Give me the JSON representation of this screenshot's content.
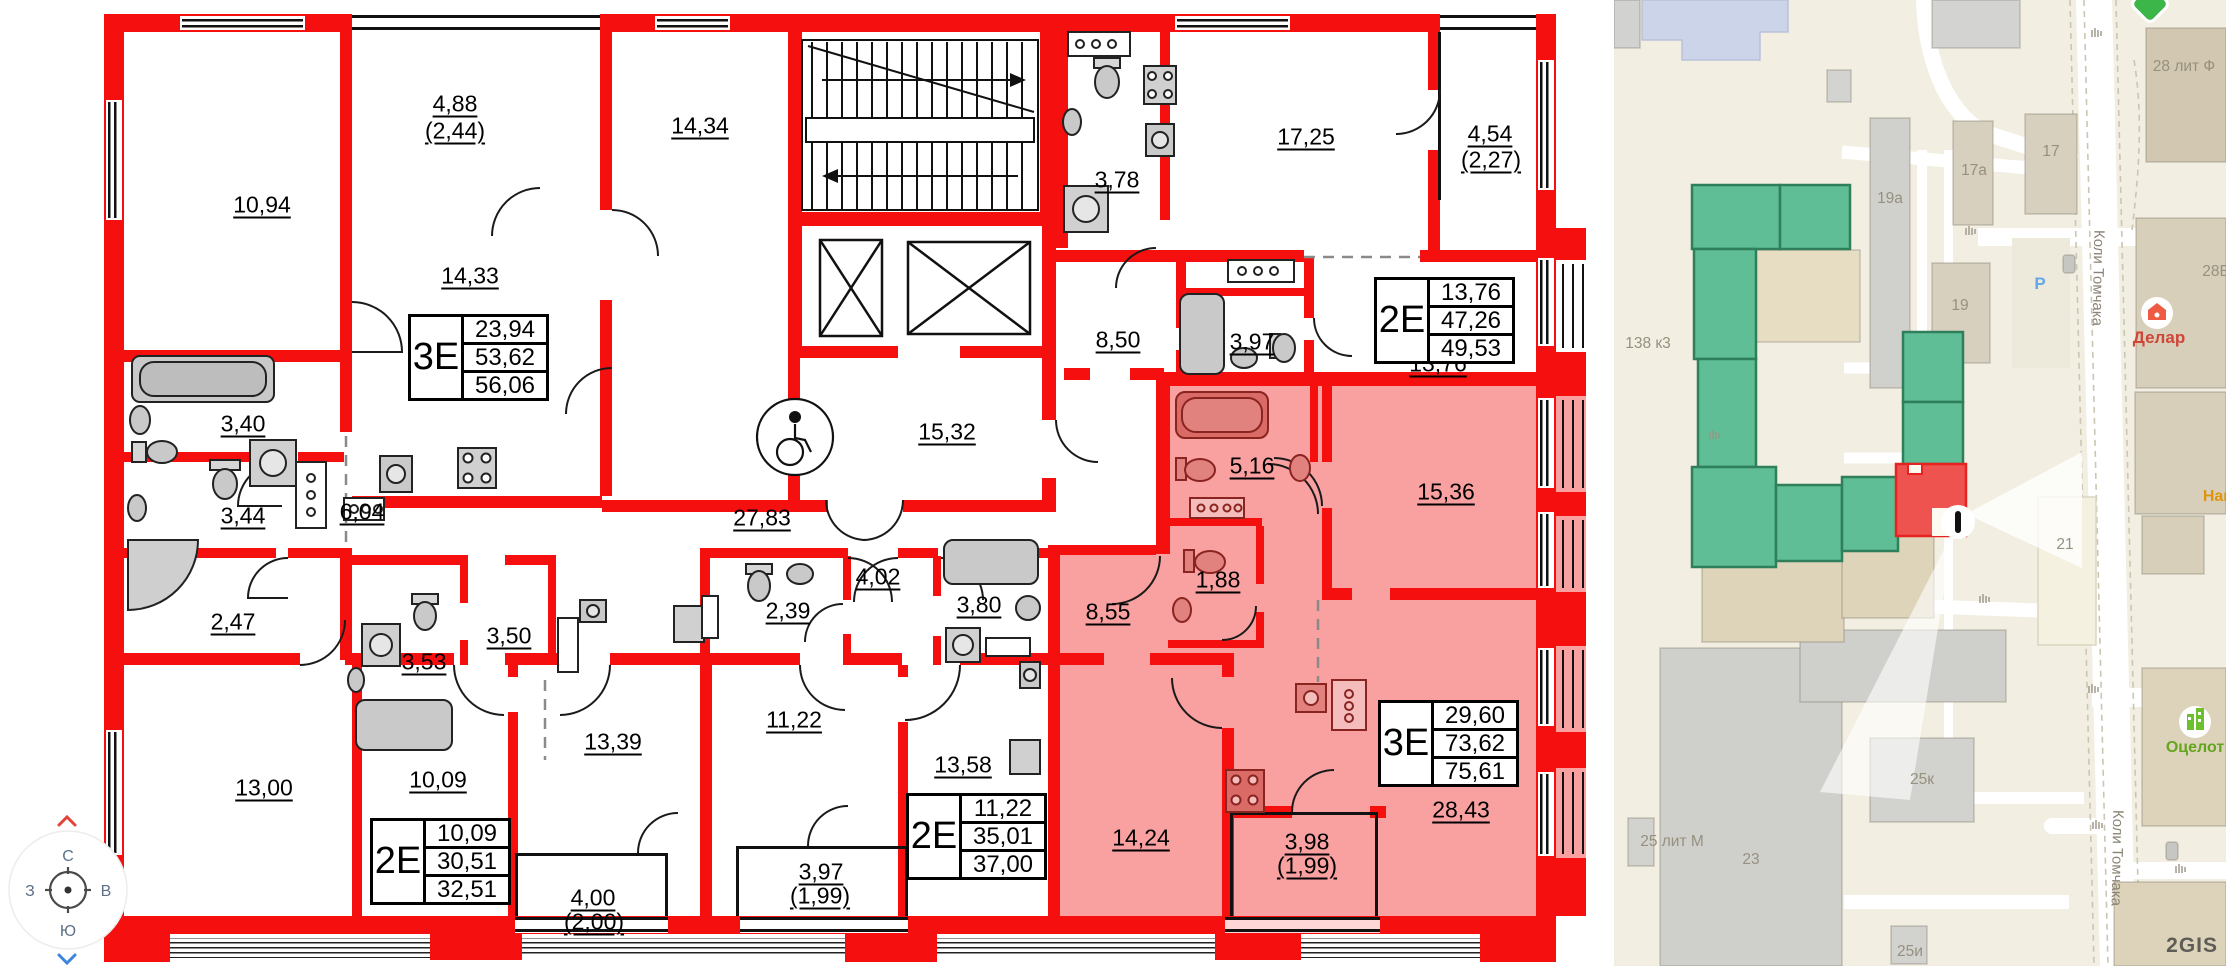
{
  "floor_plan": {
    "room_labels": [
      {
        "label": "10,94"
      },
      {
        "label": "4,88"
      },
      {
        "label": "(2,44)"
      },
      {
        "label": "14,33"
      },
      {
        "label": "14,34"
      },
      {
        "label": "15,32"
      },
      {
        "label": "3,78"
      },
      {
        "label": "17,25"
      },
      {
        "label": "4,54"
      },
      {
        "label": "(2,27)"
      },
      {
        "label": "8,50"
      },
      {
        "label": "3,97"
      },
      {
        "label": "13,76"
      },
      {
        "label": "27,83"
      },
      {
        "label": "3,40"
      },
      {
        "label": "3,44"
      },
      {
        "label": "6,04"
      },
      {
        "label": "2,47"
      },
      {
        "label": "3,53"
      },
      {
        "label": "3,50"
      },
      {
        "label": "13,00"
      },
      {
        "label": "10,09"
      },
      {
        "label": "13,39"
      },
      {
        "label": "4,00"
      },
      {
        "label": "(2,00)"
      },
      {
        "label": "2,39"
      },
      {
        "label": "4,02"
      },
      {
        "label": "3,80"
      },
      {
        "label": "11,22"
      },
      {
        "label": "13,58"
      },
      {
        "label": "3,97"
      },
      {
        "label": "(1,99)"
      },
      {
        "label": "8,55"
      },
      {
        "label": "5,16"
      },
      {
        "label": "1,88"
      },
      {
        "label": "15,36"
      },
      {
        "label": "14,24"
      },
      {
        "label": "28,43"
      },
      {
        "label": "3,98"
      },
      {
        "label": "(1,99)"
      }
    ],
    "apartments": [
      {
        "type": "3Е",
        "living": "23,94",
        "area": "53,62",
        "total": "56,06"
      },
      {
        "type": "2Е",
        "living": "13,76",
        "area": "47,26",
        "total": "49,53"
      },
      {
        "type": "2Е",
        "living": "10,09",
        "area": "30,51",
        "total": "32,51"
      },
      {
        "type": "2Е",
        "living": "11,22",
        "area": "35,01",
        "total": "37,00"
      },
      {
        "type": "3Е",
        "living": "29,60",
        "area": "73,62",
        "total": "75,61"
      }
    ],
    "colors": {
      "wall_red": "#f5100f",
      "highlight_pink": "#f9a0a0"
    }
  },
  "compass": {
    "north": "С",
    "south": "Ю",
    "west": "З",
    "east": "В"
  },
  "map": {
    "building_labels": [
      {
        "label": "28 лит Ф"
      },
      {
        "label": "17"
      },
      {
        "label": "17а"
      },
      {
        "label": "19а"
      },
      {
        "label": "28Б"
      },
      {
        "label": "19"
      },
      {
        "label": "138 к3"
      },
      {
        "label": "21"
      },
      {
        "label": "23"
      },
      {
        "label": "25к"
      },
      {
        "label": "25 лит М"
      },
      {
        "label": "25и"
      }
    ],
    "street_name": "Коли Томчака",
    "poi_delar": "Делар",
    "poi_ocelot": "Оцелот",
    "poi_partial": "Нац",
    "parking_label": "P",
    "watermark": "2GIS",
    "colors": {
      "green_building": "#5fbe96",
      "red_building": "#ee5350",
      "map_bg": "#f2efe2"
    }
  }
}
